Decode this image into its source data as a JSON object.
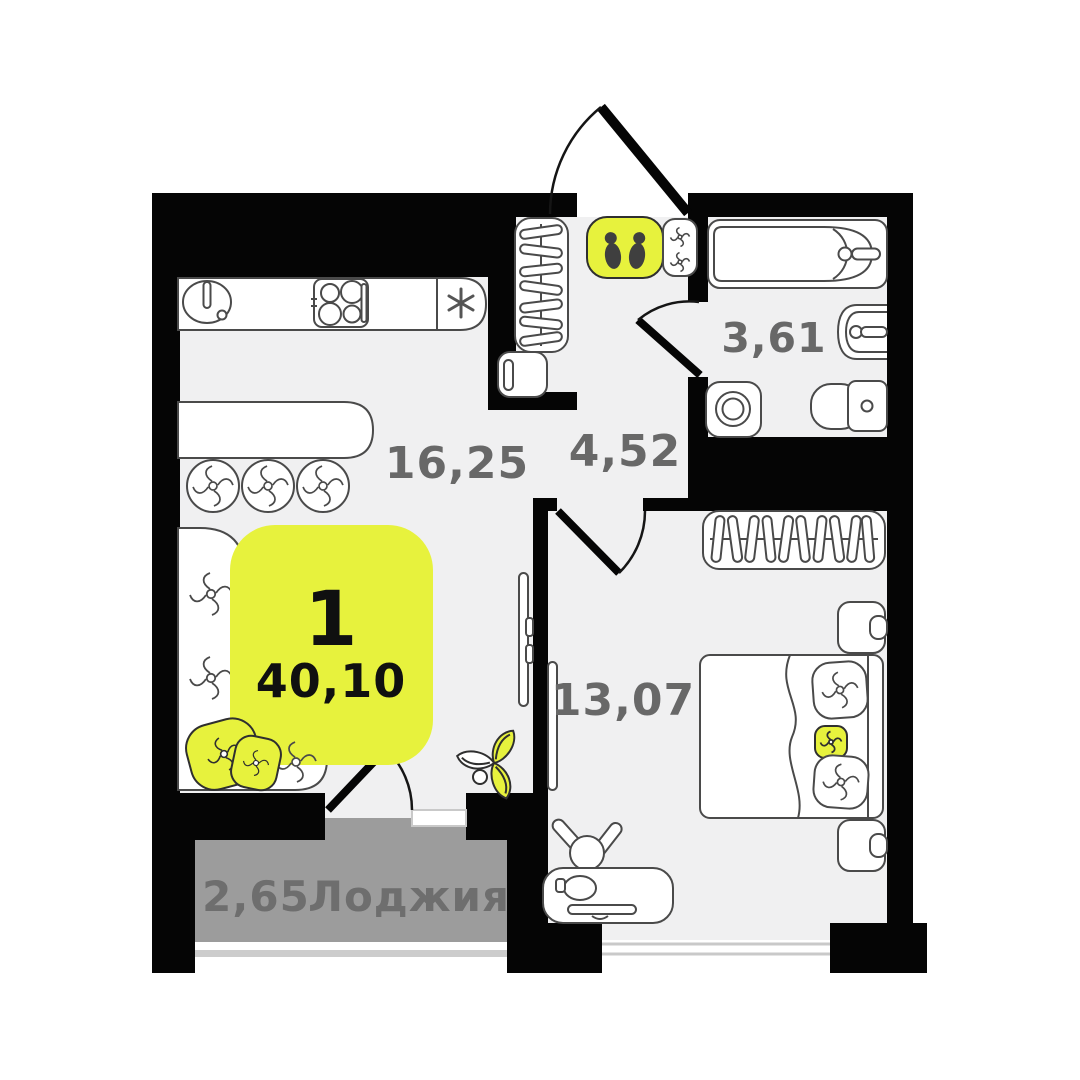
{
  "floor_plan": {
    "badge": {
      "rooms_count": "1",
      "total_area": "40,10"
    },
    "rooms": {
      "kitchen_living": {
        "area": "16,25"
      },
      "hallway": {
        "area": "4,52"
      },
      "bathroom": {
        "area": "3,61"
      },
      "bedroom": {
        "area": "13,07"
      },
      "loggia": {
        "area": "2,65",
        "name": "Лоджия"
      }
    },
    "colors": {
      "accent_yellow": "#e7f23d",
      "wall_black": "#050505",
      "floor_gray": "#f0f0f1",
      "loggia_gray": "#9c9c9c",
      "label_gray": "#686868",
      "furniture_line": "#4a4a4a",
      "window_line": "#c9c9c9"
    },
    "icons": [
      "footprints-mat-icon",
      "asterisk-fridge-icon",
      "swirl-cushion-icon",
      "hanger-icon",
      "plant-icon"
    ]
  }
}
